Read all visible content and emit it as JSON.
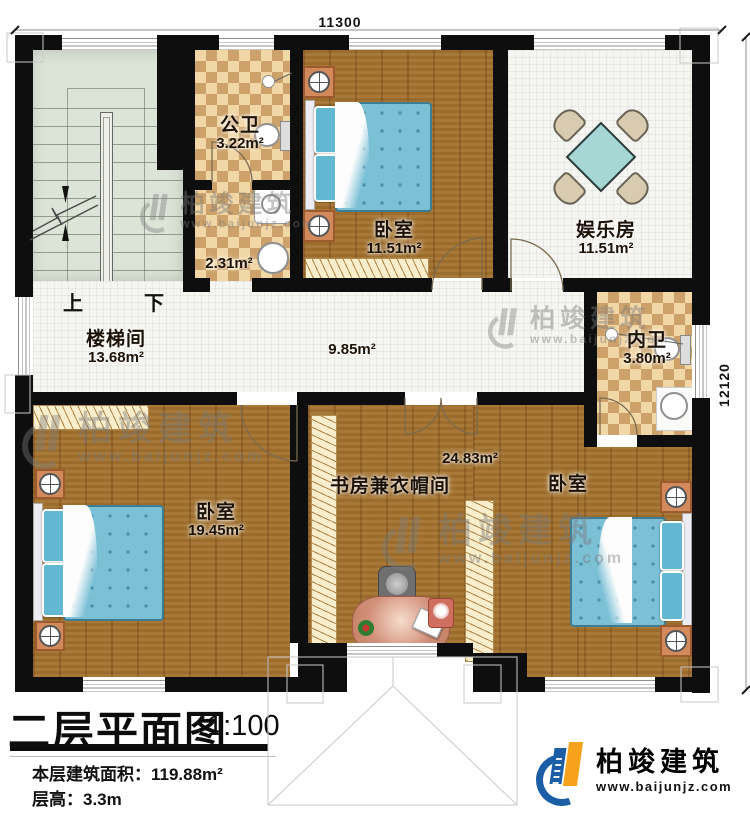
{
  "dimensions": {
    "top": "11300",
    "right": "12120"
  },
  "stairs": {
    "up": "上",
    "down": "下"
  },
  "rooms": {
    "gongwei": {
      "name": "公卫",
      "area": "3.22m²"
    },
    "corridor": {
      "area": "2.31m²"
    },
    "bedroom_top": {
      "name": "卧室",
      "area": "11.51m²"
    },
    "entertainment": {
      "name": "娱乐房",
      "area": "11.51m²"
    },
    "stairwell": {
      "name": "楼梯间",
      "area": "13.68m²"
    },
    "hallway": {
      "area": "9.85m²"
    },
    "neiwei": {
      "name": "内卫",
      "area": "3.80m²"
    },
    "bedroom_left": {
      "name": "卧室",
      "area": "19.45m²"
    },
    "study": {
      "name": "书房兼衣帽间",
      "area": "24.83m²"
    },
    "bedroom_right": {
      "name": "卧室"
    }
  },
  "title_block": {
    "title": "二层平面图",
    "scale": "1:100",
    "floor_area": "本层建筑面积：119.88m²",
    "floor_height": "层高：3.3m"
  },
  "brand": {
    "name": "柏竣建筑",
    "url": "www.baijunjz.com"
  },
  "watermark": {
    "name": "柏竣建筑",
    "url": "www.baijunjz.com"
  },
  "colors": {
    "wall": "#0e0e0e",
    "wood": "#a1702d",
    "tile": "#f5f5f2",
    "checker": "#cda26a",
    "stair": "#dce3d7",
    "brand_blue": "#1b5ea6",
    "brand_orange": "#f6a21c"
  }
}
